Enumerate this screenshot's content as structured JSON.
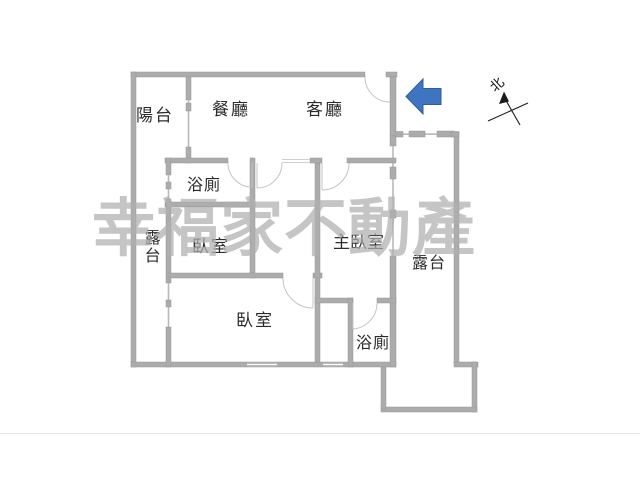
{
  "floorplan": {
    "rooms": {
      "balcony": "陽台",
      "dining": "餐廳",
      "living": "客廳",
      "bathroom_top": "浴廁",
      "terrace_left": "露台",
      "bedroom_upper": "臥室",
      "master_bedroom": "主臥室",
      "terrace_right": "露台",
      "bedroom_lower": "臥室",
      "bathroom_bottom": "浴廁"
    },
    "compass": {
      "north": "北"
    },
    "watermark": "幸福家不動產",
    "colors": {
      "wall": "#acacac",
      "entrance_arrow": "#3e74c0",
      "watermark": "#b0b0b0"
    }
  }
}
